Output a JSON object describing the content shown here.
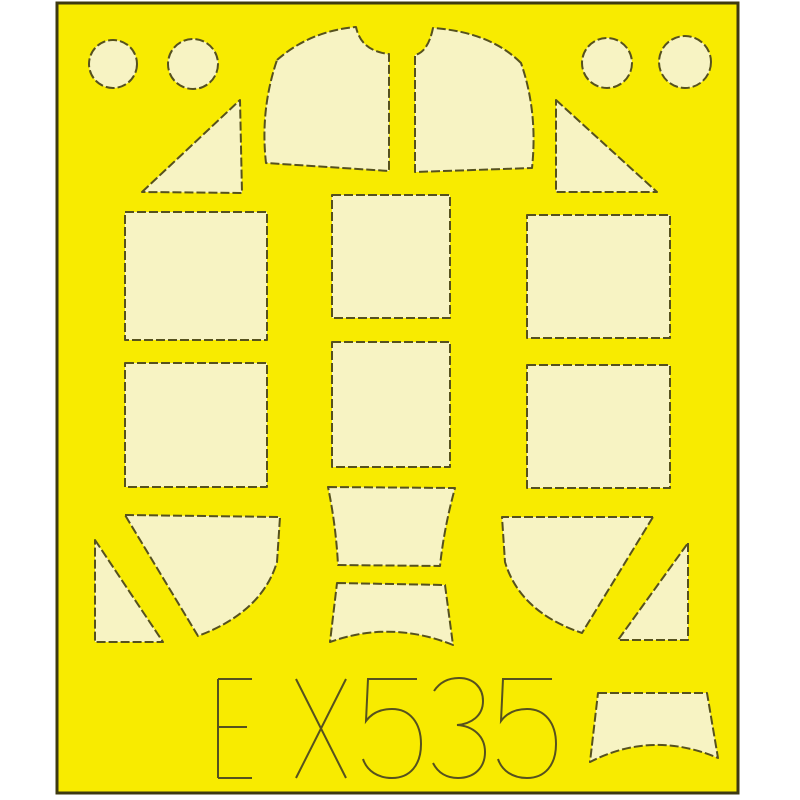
{
  "product": {
    "code": "EX535"
  },
  "colors": {
    "background": "#ffffff",
    "sheet": "#f8eb00",
    "mask": "#f7f3c3",
    "outline": "#56511e",
    "border": "#3e3a10"
  },
  "style": {
    "cut_stroke_width": 2,
    "cut_dash": "9 3",
    "label_stroke_width": 2,
    "sheet_border_width": 3
  },
  "sheet": {
    "x": 57,
    "y": 3,
    "width": 681,
    "height": 790
  },
  "masks": [
    {
      "name": "circle-top-left-1",
      "type": "circle",
      "cx": 113,
      "cy": 64,
      "r": 24
    },
    {
      "name": "circle-top-left-2",
      "type": "circle",
      "cx": 193,
      "cy": 64,
      "r": 25
    },
    {
      "name": "circle-top-right-1",
      "type": "circle",
      "cx": 607,
      "cy": 63,
      "r": 25
    },
    {
      "name": "circle-top-right-2",
      "type": "circle",
      "cx": 685,
      "cy": 62,
      "r": 26
    },
    {
      "name": "windscreen-side-left",
      "type": "path",
      "path": "M277,60 Q310,31 356,27 Q361,51 389,54 L389,171 L266,163 Q260,110 277,60 Z"
    },
    {
      "name": "windscreen-side-right",
      "type": "path",
      "path": "M521,63 Q490,32 433,28 Q428,52 415,55 L415,172 L532,168 Q538,112 521,63 Z"
    },
    {
      "name": "triangle-large-left",
      "type": "path",
      "path": "M142,192 L240,100 L242,193 Z"
    },
    {
      "name": "triangle-large-right",
      "type": "path",
      "path": "M556,100 L657,192 L556,192 Z"
    },
    {
      "name": "square-left-top",
      "type": "rect",
      "x": 125,
      "y": 212,
      "w": 142,
      "h": 128
    },
    {
      "name": "square-left-bottom",
      "type": "rect",
      "x": 125,
      "y": 363,
      "w": 142,
      "h": 124
    },
    {
      "name": "square-middle-top",
      "type": "rect",
      "x": 332,
      "y": 195,
      "w": 118,
      "h": 123
    },
    {
      "name": "square-middle-bottom",
      "type": "rect",
      "x": 332,
      "y": 342,
      "w": 118,
      "h": 125
    },
    {
      "name": "square-right-top",
      "type": "rect",
      "x": 527,
      "y": 215,
      "w": 143,
      "h": 123
    },
    {
      "name": "square-right-bottom",
      "type": "rect",
      "x": 527,
      "y": 365,
      "w": 143,
      "h": 123
    },
    {
      "name": "trapezoid-middle-upper",
      "type": "path",
      "path": "M328,487 L455,488 Q444,528 440,566 L338,565 Q336,526 328,487 Z"
    },
    {
      "name": "trapezoid-middle-lower",
      "type": "path",
      "path": "M337,583 L445,585 L453,645 Q391,620 330,642 Z"
    },
    {
      "name": "canopy-quarter-left",
      "type": "path",
      "path": "M125,515 L280,517 L277,562 Q262,612 198,636 Z"
    },
    {
      "name": "canopy-quarter-right",
      "type": "path",
      "path": "M653,517 L502,517 L505,562 Q520,612 582,633 Z"
    },
    {
      "name": "triangle-small-left",
      "type": "path",
      "path": "M95,540 L163,642 L95,642 Z"
    },
    {
      "name": "triangle-small-right",
      "type": "path",
      "path": "M688,543 L688,640 L618,640 Z"
    },
    {
      "name": "windscreen-top-bottom-right",
      "type": "path",
      "path": "M598,693 L707,693 L718,758 Q652,730 590,762 Z"
    }
  ],
  "label": {
    "text": "EX535",
    "letters": [
      "E",
      "X",
      "5",
      "3",
      "5"
    ],
    "strokes": [
      "M218,679 L218,778 M218,679 L252,679 M218,727 L247,727 M218,778 L252,778",
      "M296,679 L346,778 M346,679 L296,778",
      "M417,679 L368,679 L366,721 C372,713 381,709 392,709 C410,709 421,723 421,744 C421,765 410,778 392,778 C378,778 367,771 363,759",
      "M434,691 C440,682 449,678 459,678 C474,678 483,688 483,701 C483,716 471,724 457,725 C473,726 485,736 485,752 C485,768 474,778 458,778 C447,778 438,773 433,763",
      "M552,679 L503,679 L501,721 C507,713 516,709 527,709 C545,709 556,723 556,744 C556,765 545,778 527,778 C513,778 502,771 498,759"
    ]
  }
}
